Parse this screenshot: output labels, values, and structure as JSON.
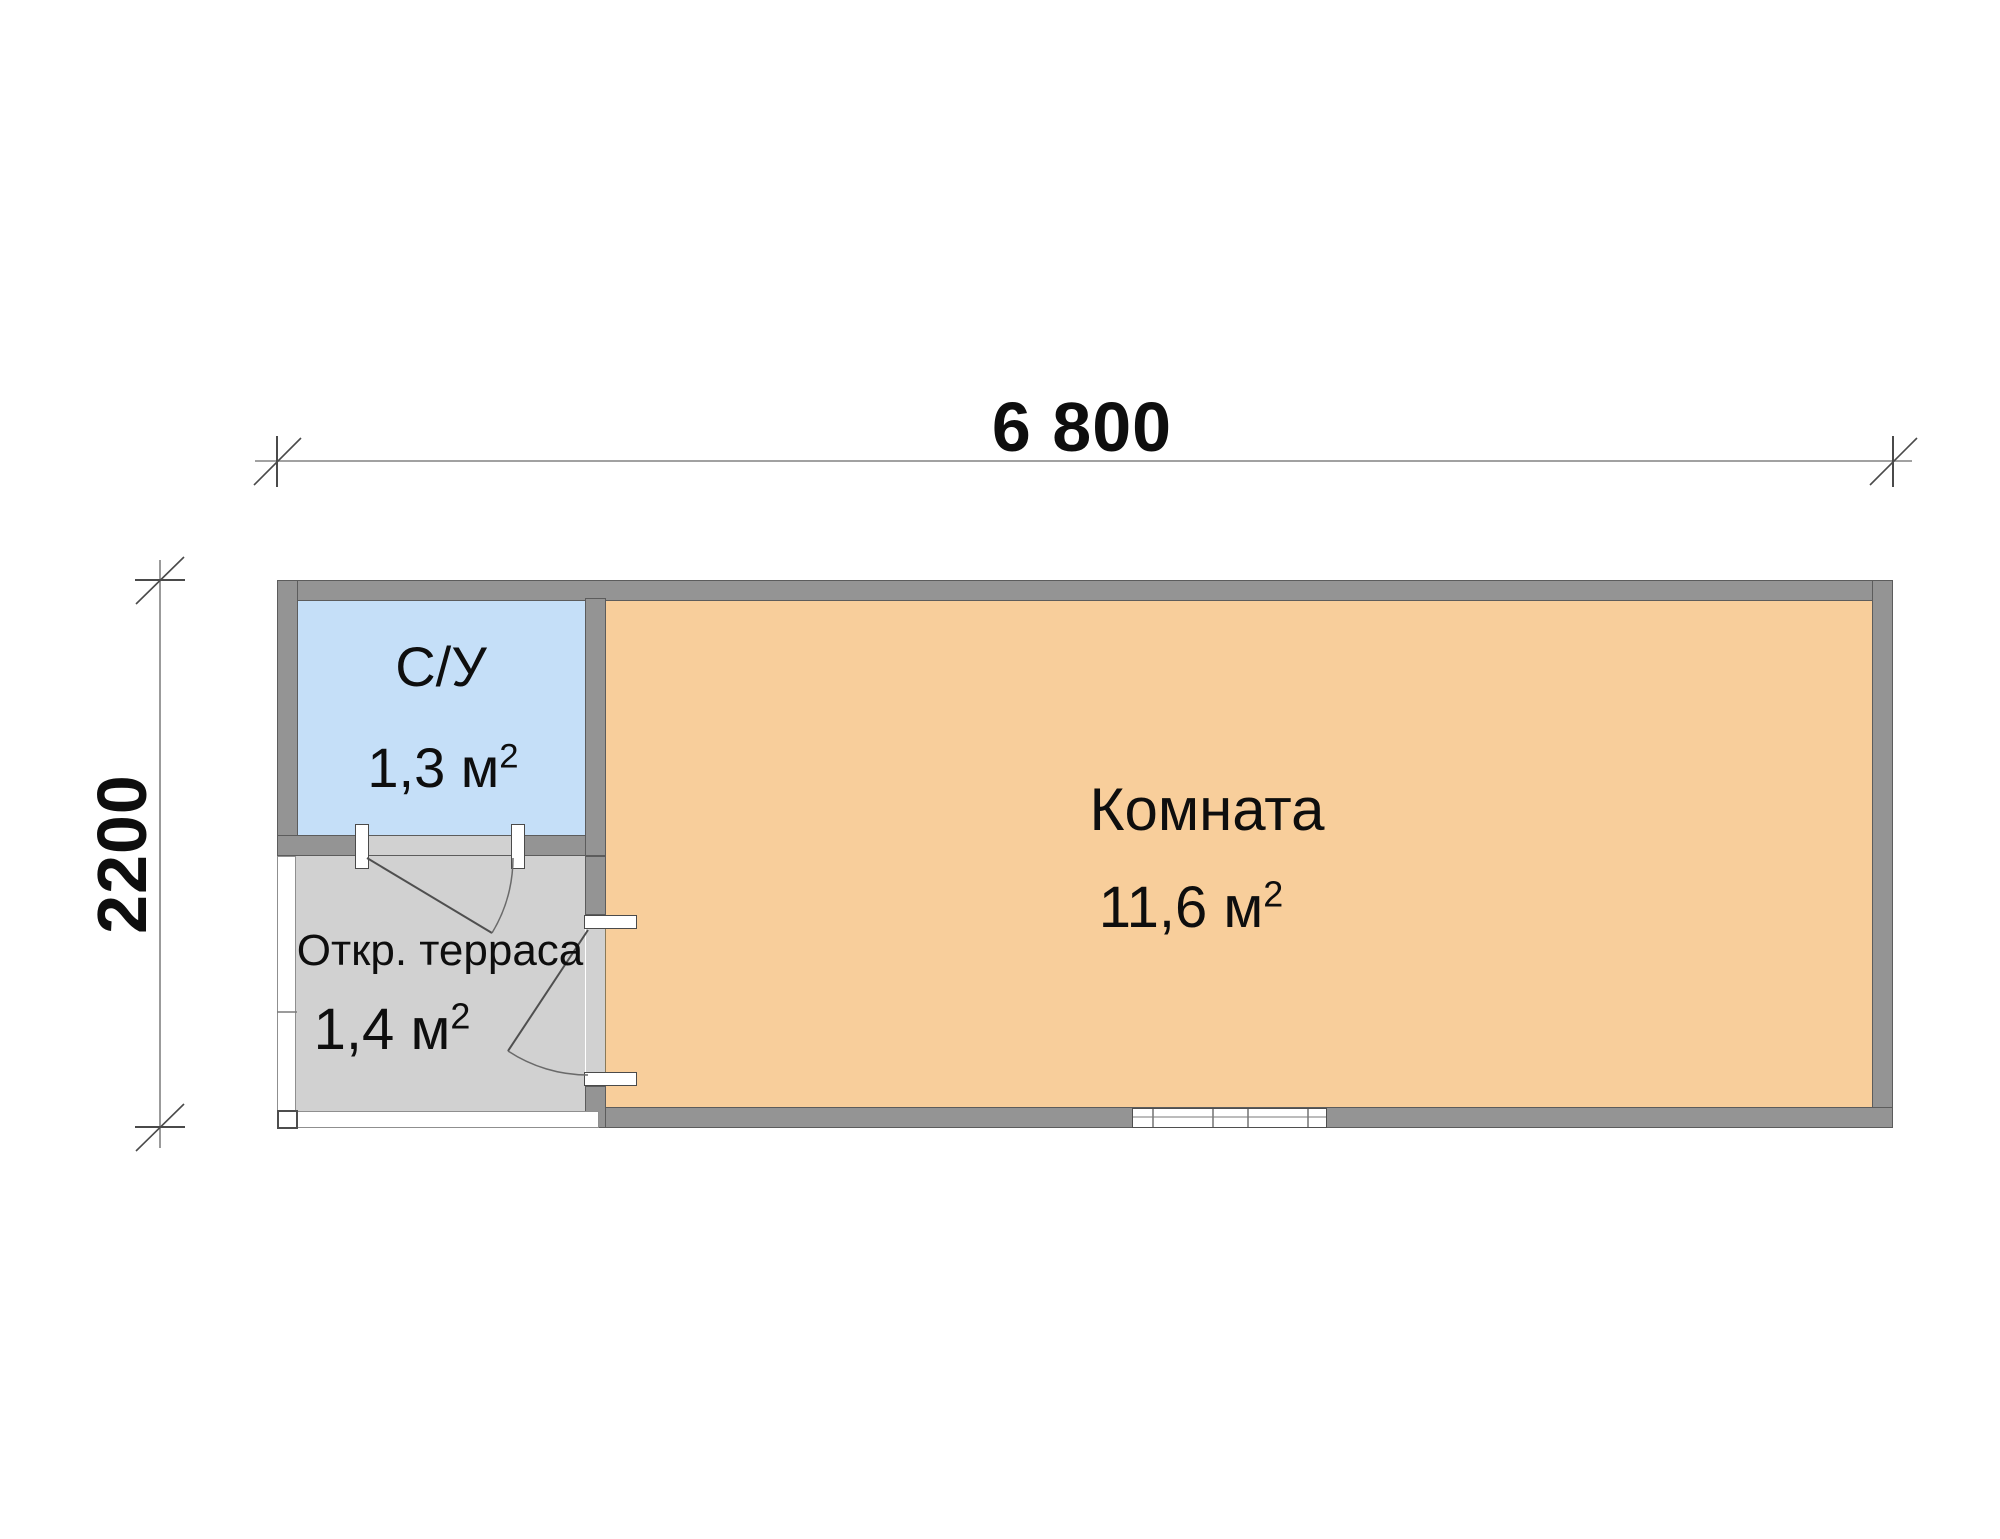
{
  "drawing": {
    "type": "floor-plan",
    "dimensions": {
      "width_label": "6 800",
      "height_label": "2200"
    },
    "rooms": [
      {
        "name": "С/У",
        "area_value": "1,3",
        "area_unit": "м",
        "area_exponent": "2",
        "fill": "#c5dff8"
      },
      {
        "name": "Откр. терраса",
        "area_value": "1,4",
        "area_unit": "м",
        "area_exponent": "2",
        "fill": "#d1d1d1"
      },
      {
        "name": "Комната",
        "area_value": "11,6",
        "area_unit": "м",
        "area_exponent": "2",
        "fill": "#f8ce9b"
      }
    ],
    "colors": {
      "background": "#ffffff",
      "wall_fill": "#949494",
      "wall_outline": "#5c5c5c",
      "su_fill": "#c5dff8",
      "room_fill": "#f8ce9b",
      "terrace_fill": "#d1d1d1",
      "dimension_line": "#828282",
      "tick": "#4a4a4a",
      "door_line": "#4f4f4f",
      "text": "#0e0e0e"
    }
  }
}
